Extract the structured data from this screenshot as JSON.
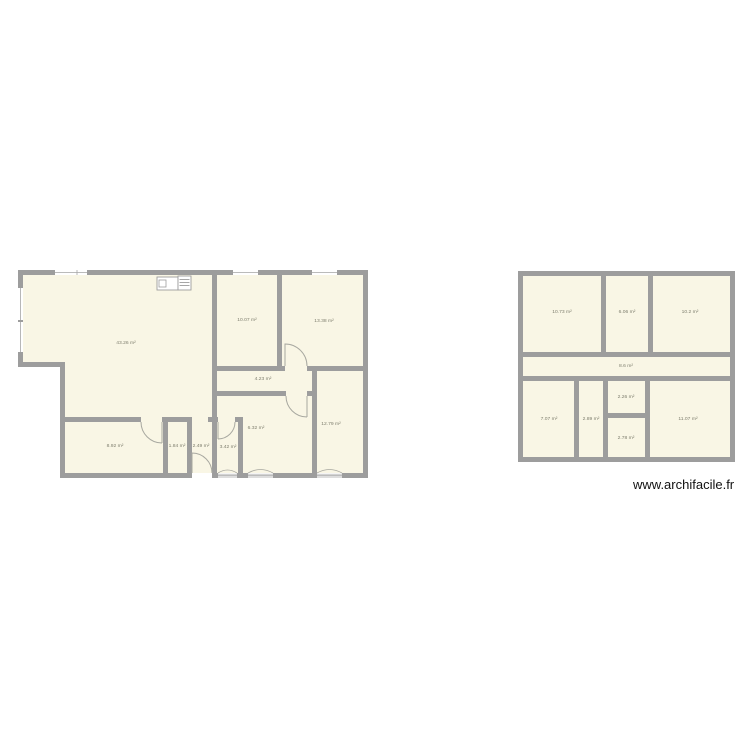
{
  "watermark": "www.archifacile.fr",
  "colors": {
    "wall": "#9d9d9d",
    "floor": "#f9f6e5",
    "door_arc": "#a8a8a0",
    "label": "#7e7e6e",
    "background": "#ffffff"
  },
  "plans": [
    {
      "name": "left-floor-plan",
      "rooms": [
        {
          "area": "43.26 m²"
        },
        {
          "area": "10.07 m²"
        },
        {
          "area": "13.38 m²"
        },
        {
          "area": "4.23 m²"
        },
        {
          "area": "6.32 m²"
        },
        {
          "area": "12.79 m²"
        },
        {
          "area": "8.92 m²"
        },
        {
          "area": "1.84 m²"
        },
        {
          "area": "2.49 m²"
        },
        {
          "area": "3.42 m²"
        }
      ]
    },
    {
      "name": "right-floor-plan",
      "rooms": [
        {
          "area": "10.73 m²"
        },
        {
          "area": "6.06 m²"
        },
        {
          "area": "10.2 m²"
        },
        {
          "area": "8.6 m²"
        },
        {
          "area": "7.07 m²"
        },
        {
          "area": "2.89 m²"
        },
        {
          "area": "2.26 m²"
        },
        {
          "area": "2.78 m²"
        },
        {
          "area": "11.07 m²"
        }
      ]
    }
  ]
}
